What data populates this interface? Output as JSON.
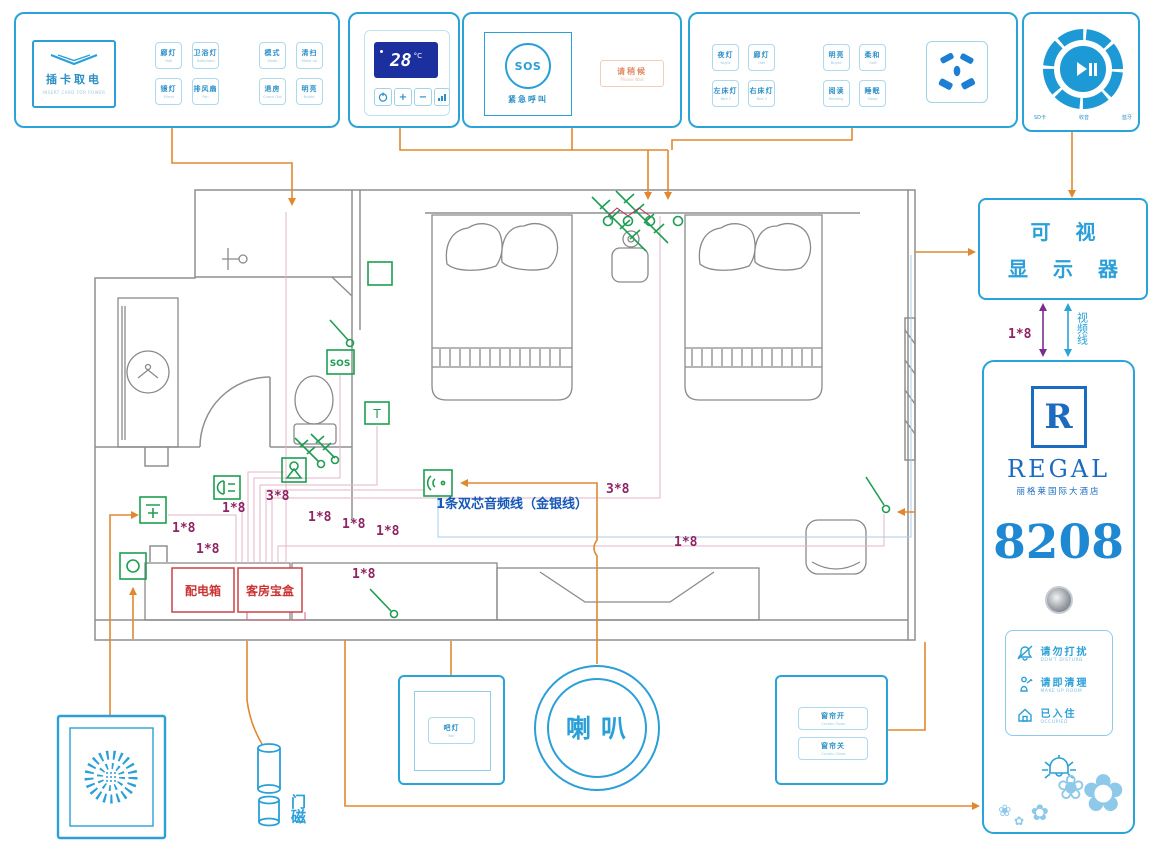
{
  "panels": {
    "p1": {
      "card_title": "插卡取电",
      "card_sub": "INSERT CARD FOR POWER",
      "buttons": [
        {
          "cn": "廊灯",
          "en": "Hall"
        },
        {
          "cn": "卫浴灯",
          "en": "Bathroom"
        },
        {
          "cn": "镜灯",
          "en": "Mirror"
        },
        {
          "cn": "排风扇",
          "en": "Fan"
        },
        {
          "cn": "模式",
          "en": "Mode"
        },
        {
          "cn": "清扫",
          "en": "Make up"
        },
        {
          "cn": "退房",
          "en": "Check Out"
        },
        {
          "cn": "明亮",
          "en": "Bright"
        }
      ]
    },
    "p2": {
      "temp": "28",
      "unit": "°C",
      "plus": "+",
      "minus": "−"
    },
    "p3": {
      "sos": "SOS",
      "label": "紧急呼叫",
      "wait_cn": "请稍候",
      "wait_en": "Please Wait"
    },
    "p4": {
      "buttons": [
        {
          "cn": "夜灯",
          "en": "Night"
        },
        {
          "cn": "廊灯",
          "en": "Hall"
        },
        {
          "cn": "左床灯",
          "en": "Bed 1"
        },
        {
          "cn": "右床灯",
          "en": "Bed 2"
        },
        {
          "cn": "明亮",
          "en": "Bright"
        },
        {
          "cn": "柔和",
          "en": "Soft"
        },
        {
          "cn": "阅读",
          "en": "Reading"
        },
        {
          "cn": "睡眠",
          "en": "Sleep"
        }
      ]
    },
    "p5": {
      "labels": [
        "SD卡",
        "收音",
        "蓝牙"
      ]
    }
  },
  "display": {
    "line1": "可 视",
    "line2": "显 示 器",
    "wire": "1*8",
    "video": "视频线"
  },
  "regal": {
    "logo": "R",
    "brand": "REGAL",
    "cn": "丽格莱国际大酒店",
    "room": "8208",
    "indicators": [
      {
        "cn": "请勿打扰",
        "en": "DON'T DISTURB"
      },
      {
        "cn": "请即清理",
        "en": "MAKE UP ROOM"
      },
      {
        "cn": "已入住",
        "en": "OCCUPIED"
      }
    ],
    "flowers": [
      "✿",
      "❀",
      "✿",
      "❀",
      "✿"
    ]
  },
  "plan": {
    "sos": "SOS",
    "t": "T",
    "dist_box": "配电箱",
    "room_box": "客房宝盒",
    "speaker": "喇叭",
    "door_magnet": "门磁",
    "audio_note": "1条双芯音频线（金银线）",
    "wire_labels": [
      "1*8",
      "1*8",
      "1*8",
      "3*8",
      "1*8",
      "1*8",
      "1*8",
      "1*8",
      "3*8",
      "1*8"
    ],
    "bar": {
      "cn": "吧灯",
      "en": "Bar"
    },
    "curtains": [
      {
        "cn": "窗帘开",
        "en": "Curtain Open"
      },
      {
        "cn": "窗帘关",
        "en": "Curtain Close"
      }
    ]
  }
}
